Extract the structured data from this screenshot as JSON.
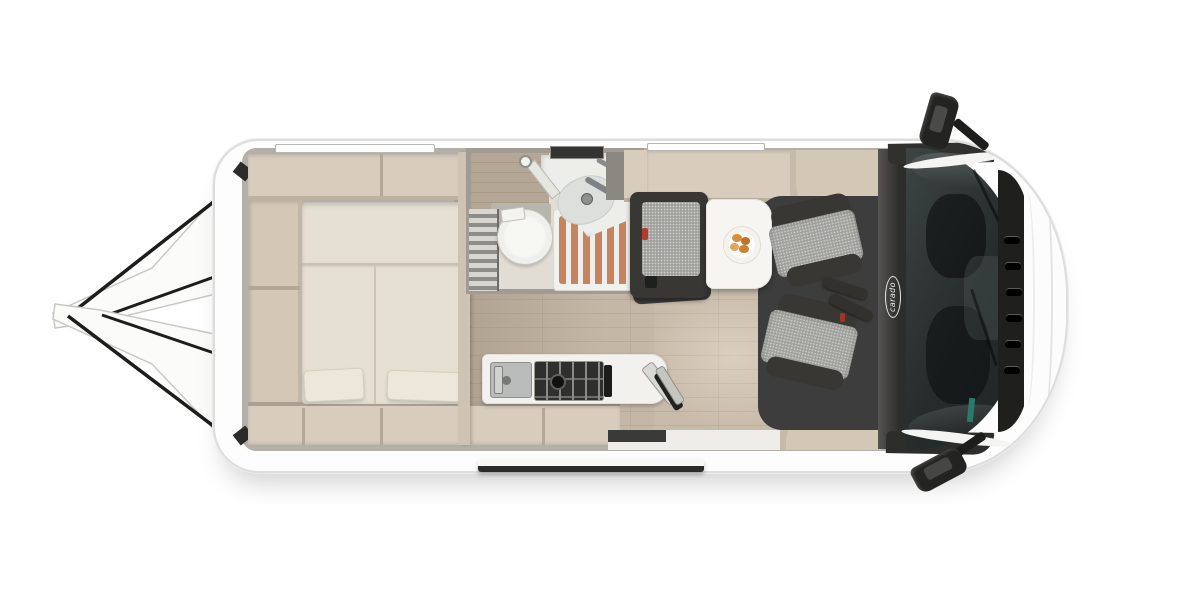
{
  "vehicle": {
    "brand_logo": "carado",
    "type": "camper-van-floor-plan",
    "view": "top-down"
  },
  "palette": {
    "background": "#ffffff",
    "body_white": "#fdfdfd",
    "interior_wall_gray": "#b4b0a9",
    "furniture_beige": "#d8cdbd",
    "bed_cream": "#e6e0d3",
    "floor_wood": "#c8bbaa",
    "floor_wood_gray": "#a89a89",
    "shower_slats_terracotta": "#c5845f",
    "bathroom_fixture_white": "#efefeb",
    "seat_fabric_gray": "#a0a09c",
    "seat_trim_charcoal": "#393733",
    "dinette_floor_charcoal": "#3c3d3c",
    "glass_dark": "#262b2b",
    "mirror_black": "#232322",
    "accent_red_buckle": "#b23b2c",
    "accent_teal_belt": "#2a7a6b",
    "pastry_orange": "#d98e3f"
  }
}
